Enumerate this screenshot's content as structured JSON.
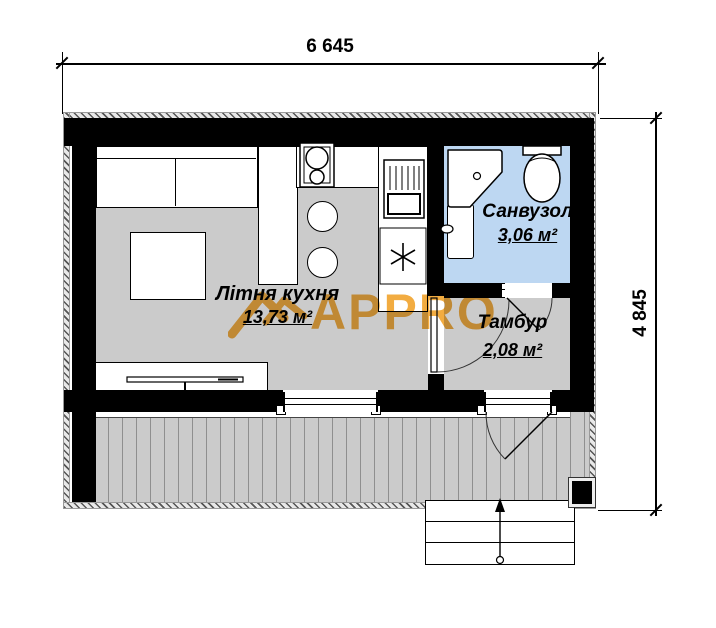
{
  "dimensions": {
    "width_top": "6 645",
    "height_right": "4 845"
  },
  "rooms": [
    {
      "name": "Літня кухня",
      "area": "13,73 м²"
    },
    {
      "name": "Санвузол",
      "area": "3,06 м²"
    },
    {
      "name": "Тамбур",
      "area": "2,08 м²"
    }
  ],
  "watermark": {
    "text": "APPRO",
    "color": "#f1a531"
  },
  "colors": {
    "wall": "#000000",
    "floor_gray": "#cbcbcb",
    "bathroom_blue": "#bdd7f2",
    "deck_plank_line": "#8f8f8f",
    "hatch_line": "#555555"
  },
  "icons": {
    "freezer": "snowflake-asterisk-icon",
    "stairs_direction": "up-arrow-icon",
    "watermark_logo": "house-roof-icon"
  }
}
